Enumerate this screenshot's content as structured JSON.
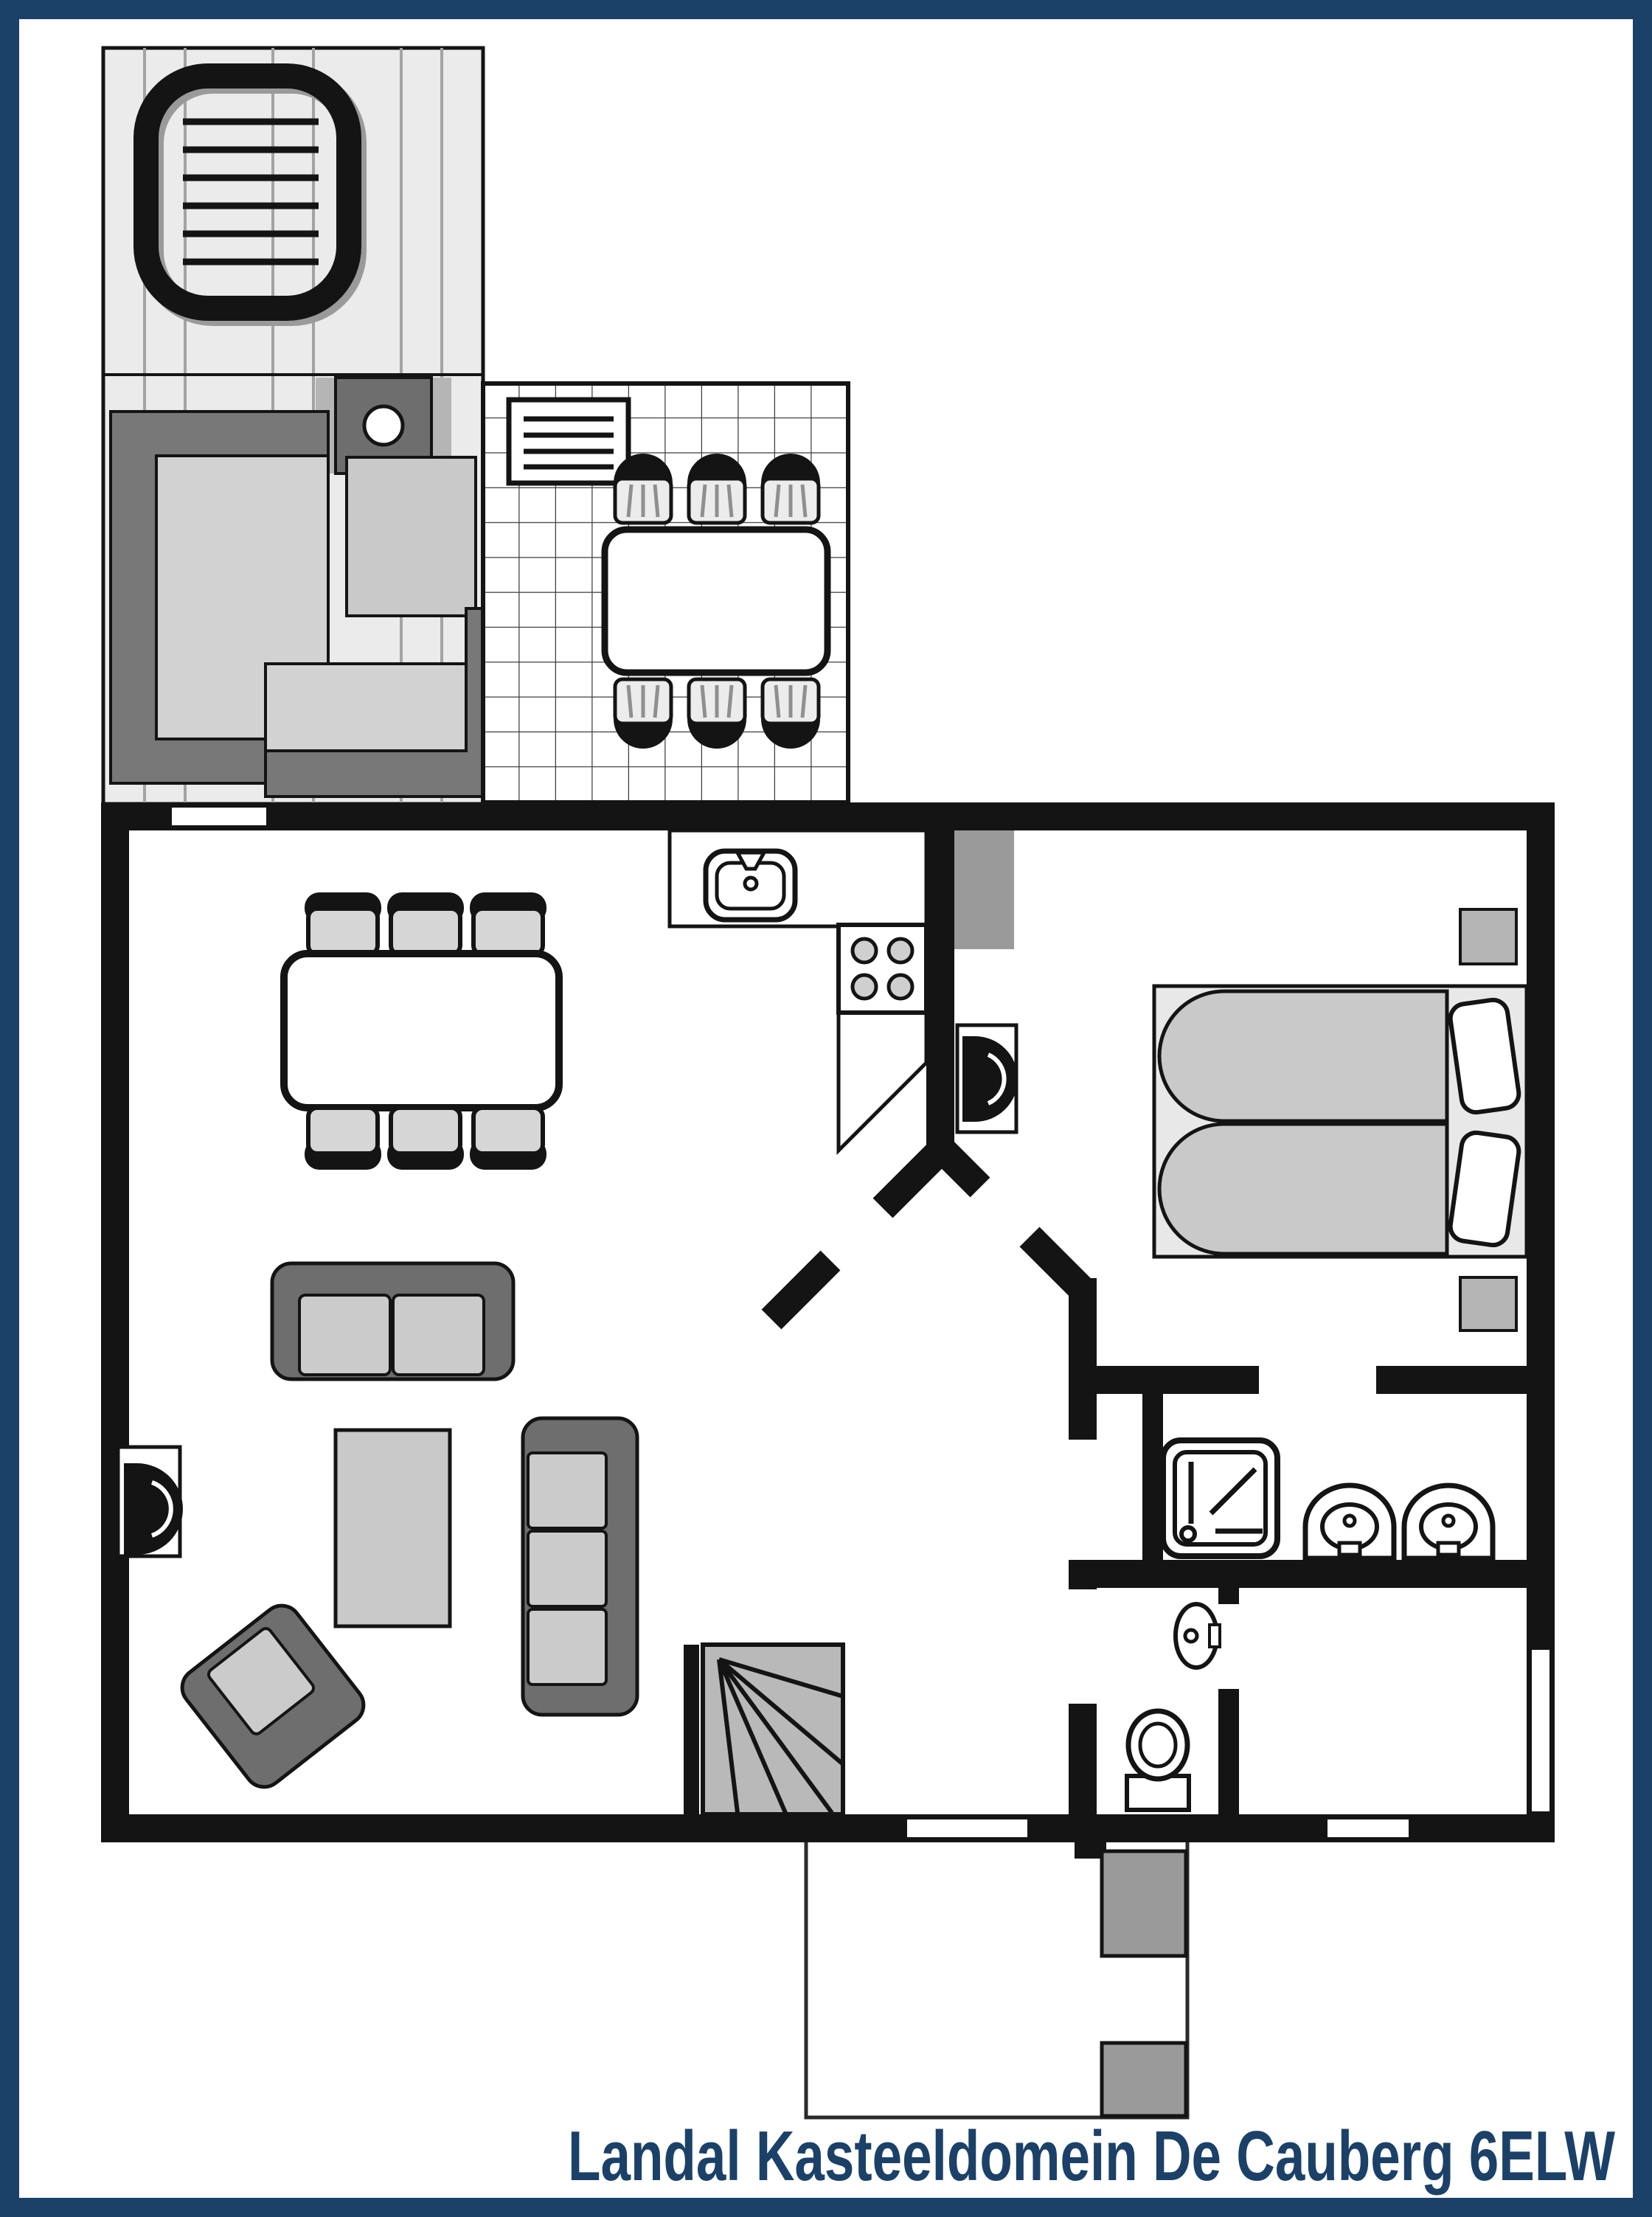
{
  "title": {
    "text": "Landal Kasteeldomein De Cauberg 6ELW"
  },
  "colors": {
    "frame": "#1b4168",
    "wall": "#141414",
    "outline": "#141414",
    "deck": "#ebebeb",
    "light": "#c9c9c9",
    "mid": "#9a9a9a",
    "dark": "#6e6e6e"
  },
  "plan": {
    "type": "floor-plan",
    "areas": [
      {
        "name": "sauna-deck",
        "furniture": [
          "hot-tub",
          "sauna-heater",
          "lounge-bench",
          "side-table",
          "corner-bench"
        ]
      },
      {
        "name": "terrace",
        "furniture": [
          "vent-grille",
          "outdoor-dining-table",
          "outdoor-chair x6"
        ]
      },
      {
        "name": "living-dining-room",
        "furniture": [
          "dining-table",
          "dining-chair x6",
          "two-seat-sofa",
          "coffee-table",
          "three-seat-sofa",
          "armchair",
          "tv"
        ]
      },
      {
        "name": "kitchen",
        "furniture": [
          "counter",
          "sink",
          "stove-4-burners"
        ]
      },
      {
        "name": "hall",
        "furniture": [
          "winder-stairs"
        ]
      },
      {
        "name": "bedroom",
        "furniture": [
          "wardrobe",
          "tv",
          "double-bed",
          "pillow x2",
          "nightstand x2"
        ]
      },
      {
        "name": "bathroom",
        "furniture": [
          "shower",
          "washbasin x2"
        ]
      },
      {
        "name": "toilet-room",
        "furniture": [
          "toilet",
          "hand-basin"
        ]
      },
      {
        "name": "storage-room",
        "furniture": []
      },
      {
        "name": "porch",
        "furniture": [
          "planter x2"
        ]
      }
    ]
  }
}
